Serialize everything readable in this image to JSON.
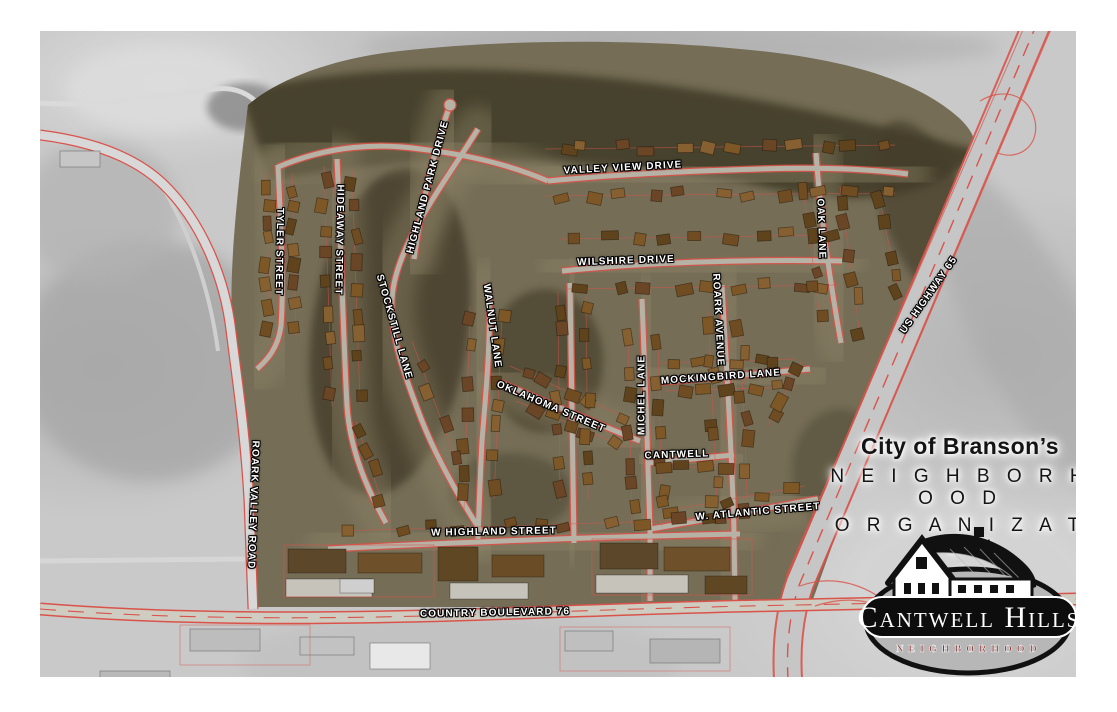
{
  "title_block": {
    "line1": "City of Branson’s",
    "line2": "N E I G H B O R H O O D",
    "line3": "O R G A N I Z A T I O N",
    "connector": "of"
  },
  "badge": {
    "name": "Cantwell Hills",
    "subtitle": "NEIGHBORHOOD"
  },
  "street_labels": [
    {
      "id": "valley-view-drive",
      "text": "VALLEY VIEW DRIVE",
      "x": 583,
      "y": 137,
      "rot": -3
    },
    {
      "id": "wilshire-drive",
      "text": "WILSHIRE DRIVE",
      "x": 586,
      "y": 230,
      "rot": -2
    },
    {
      "id": "oak-lane",
      "text": "OAK LANE",
      "x": 781,
      "y": 198,
      "rot": 88
    },
    {
      "id": "tyler-street",
      "text": "TYLER STREET",
      "x": 239,
      "y": 221,
      "rot": 91
    },
    {
      "id": "hideaway-street",
      "text": "HIDEAWAY STREET",
      "x": 299,
      "y": 209,
      "rot": 91
    },
    {
      "id": "highland-park-drive",
      "text": "HIGHLAND PARK DRIVE",
      "x": 388,
      "y": 156,
      "rot": -75
    },
    {
      "id": "stockstill-lane",
      "text": "STOCKSTILL LANE",
      "x": 354,
      "y": 296,
      "rot": 74
    },
    {
      "id": "walnut-lane",
      "text": "WALNUT LANE",
      "x": 452,
      "y": 295,
      "rot": 82
    },
    {
      "id": "oklahoma-street",
      "text": "OKLAHOMA STREET",
      "x": 511,
      "y": 376,
      "rot": 23
    },
    {
      "id": "michel-lane",
      "text": "MICHEL LANE",
      "x": 602,
      "y": 364,
      "rot": -90
    },
    {
      "id": "mockingbird-lane",
      "text": "MOCKINGBIRD LANE",
      "x": 681,
      "y": 346,
      "rot": -4
    },
    {
      "id": "roark-avenue",
      "text": "ROARK AVENUE",
      "x": 678,
      "y": 289,
      "rot": 87
    },
    {
      "id": "cantwell",
      "text": "CANTWELL",
      "x": 637,
      "y": 424,
      "rot": -2
    },
    {
      "id": "w-atlantic-street",
      "text": "W. ATLANTIC STREET",
      "x": 718,
      "y": 481,
      "rot": -5
    },
    {
      "id": "w-highland-street",
      "text": "W HIGHLAND STREET",
      "x": 454,
      "y": 501,
      "rot": -1
    },
    {
      "id": "country-boulevard-76",
      "text": "COUNTRY BOULEVARD 76",
      "x": 455,
      "y": 582,
      "rot": -1
    },
    {
      "id": "us-highway-65",
      "text": "US HIGHWAY 65",
      "x": 889,
      "y": 264,
      "rot": -55
    },
    {
      "id": "roark-valley-road",
      "text": "ROARK VALLEY ROAD",
      "x": 213,
      "y": 474,
      "rot": 92
    }
  ],
  "colors": {
    "road_red": "#d9534a",
    "street_gray": "#b6b2a6",
    "outside_gray": "#c9c9c9",
    "neighborhood_ground": "#756d56",
    "forest_dark": "#403b28",
    "house_brown": "#6f4c22",
    "label_text": "#ffffff",
    "badge_oval_gray": "#b7b7b7",
    "badge_pill_black": "#0d0d0d",
    "badge_subtitle_red": "#8b2424",
    "title_text": "#141414"
  }
}
